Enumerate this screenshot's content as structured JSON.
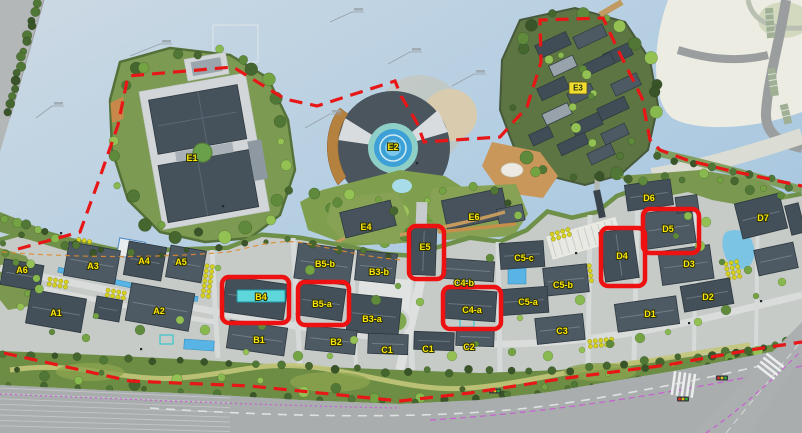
{
  "map": {
    "type": "site-plan-rendering",
    "description": "Aerial master plan with labeled building parcels, red dashed project boundary and red boxes highlighting six parcels",
    "highlighted_parcels": [
      "B4",
      "B5-a",
      "E5",
      "C4-a",
      "D4",
      "D5"
    ],
    "labels": [
      {
        "text": "E1",
        "x": 192,
        "y": 158,
        "variant": "yellow"
      },
      {
        "text": "E2",
        "x": 393,
        "y": 147,
        "variant": "yellow"
      },
      {
        "text": "E3",
        "x": 578,
        "y": 88,
        "variant": "yellow-box"
      },
      {
        "text": "E4",
        "x": 366,
        "y": 227,
        "variant": "yellow"
      },
      {
        "text": "E5",
        "x": 425,
        "y": 247,
        "variant": "yellow"
      },
      {
        "text": "E6",
        "x": 474,
        "y": 217,
        "variant": "yellow"
      },
      {
        "text": "A6",
        "x": 22,
        "y": 270,
        "variant": "yellow"
      },
      {
        "text": "A3",
        "x": 93,
        "y": 266,
        "variant": "yellow"
      },
      {
        "text": "A4",
        "x": 144,
        "y": 261,
        "variant": "yellow"
      },
      {
        "text": "A5",
        "x": 181,
        "y": 262,
        "variant": "yellow"
      },
      {
        "text": "A1",
        "x": 56,
        "y": 313,
        "variant": "yellow"
      },
      {
        "text": "A2",
        "x": 159,
        "y": 311,
        "variant": "yellow"
      },
      {
        "text": "B4",
        "x": 261,
        "y": 297,
        "variant": "cyan-box"
      },
      {
        "text": "B5-b",
        "x": 325,
        "y": 264,
        "variant": "yellow"
      },
      {
        "text": "B5-a",
        "x": 322,
        "y": 304,
        "variant": "yellow"
      },
      {
        "text": "B3-b",
        "x": 379,
        "y": 272,
        "variant": "yellow"
      },
      {
        "text": "B3-a",
        "x": 372,
        "y": 319,
        "variant": "yellow"
      },
      {
        "text": "B1",
        "x": 259,
        "y": 340,
        "variant": "yellow"
      },
      {
        "text": "B2",
        "x": 336,
        "y": 342,
        "variant": "yellow"
      },
      {
        "text": "C1",
        "x": 387,
        "y": 350,
        "variant": "yellow"
      },
      {
        "text": "C1",
        "x": 428,
        "y": 349,
        "variant": "yellow"
      },
      {
        "text": "C2",
        "x": 469,
        "y": 347,
        "variant": "yellow"
      },
      {
        "text": "C3",
        "x": 562,
        "y": 331,
        "variant": "yellow"
      },
      {
        "text": "C4-b",
        "x": 464,
        "y": 283,
        "variant": "yellow"
      },
      {
        "text": "C4-a",
        "x": 472,
        "y": 310,
        "variant": "yellow"
      },
      {
        "text": "C5-c",
        "x": 524,
        "y": 258,
        "variant": "yellow"
      },
      {
        "text": "C5-b",
        "x": 563,
        "y": 285,
        "variant": "yellow"
      },
      {
        "text": "C5-a",
        "x": 528,
        "y": 302,
        "variant": "yellow"
      },
      {
        "text": "D1",
        "x": 650,
        "y": 314,
        "variant": "yellow"
      },
      {
        "text": "D2",
        "x": 708,
        "y": 297,
        "variant": "yellow"
      },
      {
        "text": "D3",
        "x": 689,
        "y": 264,
        "variant": "yellow"
      },
      {
        "text": "D4",
        "x": 622,
        "y": 256,
        "variant": "yellow"
      },
      {
        "text": "D5",
        "x": 668,
        "y": 229,
        "variant": "yellow"
      },
      {
        "text": "D6",
        "x": 649,
        "y": 198,
        "variant": "yellow"
      },
      {
        "text": "D7",
        "x": 763,
        "y": 218,
        "variant": "yellow"
      }
    ],
    "highlight_boxes": [
      {
        "target": "B4",
        "x": 222,
        "y": 277,
        "w": 67,
        "h": 46
      },
      {
        "target": "B5-a",
        "x": 298,
        "y": 282,
        "w": 51,
        "h": 43
      },
      {
        "target": "E5",
        "x": 409,
        "y": 226,
        "w": 35,
        "h": 53
      },
      {
        "target": "C4-a",
        "x": 443,
        "y": 287,
        "w": 58,
        "h": 42
      },
      {
        "target": "D4",
        "x": 601,
        "y": 228,
        "w": 44,
        "h": 58
      },
      {
        "target": "D5",
        "x": 643,
        "y": 209,
        "w": 56,
        "h": 44
      }
    ],
    "colors": {
      "highlight_red": "#ee1111",
      "boundary_red": "#e81717",
      "label_yellow": "#ffe608",
      "label_outline": "#2a3208",
      "b4_cyan": "#5ed7db",
      "water": "#b4cfe2",
      "vegetation": "#6d8d44",
      "building_roof": "#46525c",
      "road": "#a9adae"
    }
  }
}
